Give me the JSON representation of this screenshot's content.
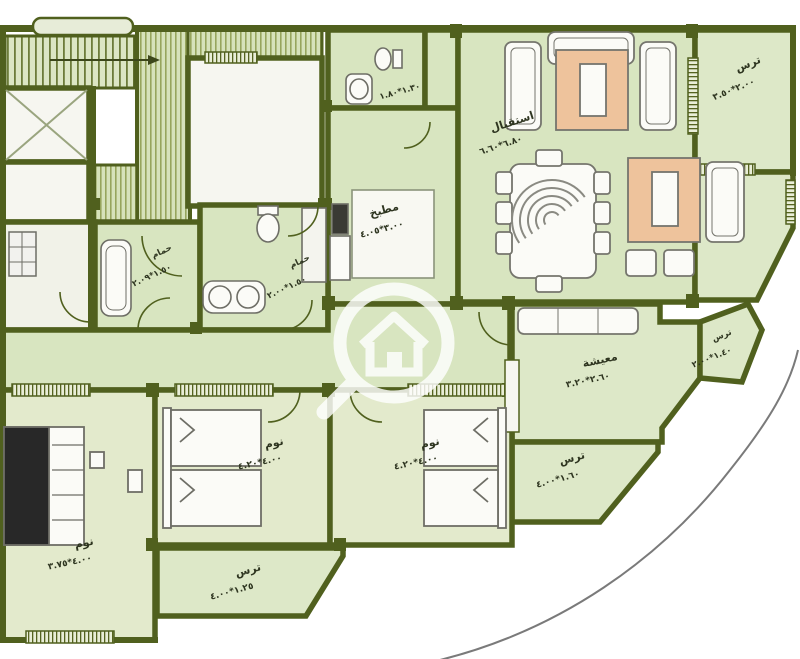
{
  "plan": {
    "type": "apartment-floor-plan",
    "rooms": {
      "reception": {
        "label": "استقبال",
        "dims": "٦.٨٠*٦.٦٠"
      },
      "kitchen": {
        "label": "مطبخ",
        "dims": "٣.٠٠*٤.٠٥"
      },
      "living": {
        "label": "معيشة",
        "dims": "٢.٦٠*٣.٢٠"
      },
      "bath_top": {
        "dims": "١.٣٠*١.٨٠"
      },
      "bath_left": {
        "label": "حمام",
        "dims": "١.٥٠*٢.٠٩"
      },
      "bath_mid": {
        "label": "حمام",
        "dims": "١.٥٠*٢.٠٠"
      },
      "bed_left": {
        "label": "نوم",
        "dims": "٤.٠٠*٣.٧٥"
      },
      "bed_mid": {
        "label": "نوم",
        "dims": "٤.٠٠*٤.٢٠"
      },
      "bed_right": {
        "label": "نوم",
        "dims": "٤.٠٠*٤.٢٠"
      },
      "terrace_top_right": {
        "label": "ترس",
        "dims": "٢.٠٠*٣.٥٠"
      },
      "terrace_right": {
        "label": "ترس",
        "dims": "١.٤٠*٢.٠٠"
      },
      "terrace_mid": {
        "label": "ترس",
        "dims": "١.٦٠*٤.٠٠"
      },
      "terrace_bottom": {
        "label": "ترس",
        "dims": "١.٢٥*٤.٠٠"
      }
    },
    "icons": {
      "watermark": "magnifier-house-icon"
    },
    "colors": {
      "wall": "#50601e",
      "room_green": "#d8e5c0",
      "room_warm": "#e3eacc",
      "terrace_green": "#dde8c8",
      "white_room": "#f6f6f0",
      "stripe_line": "#96a55c",
      "accent_table_orange": "#eec39c",
      "furniture_outline": "#6e6e66",
      "boundary_arc": "#7a7a7a",
      "watermark_white": "#ffffff"
    }
  }
}
